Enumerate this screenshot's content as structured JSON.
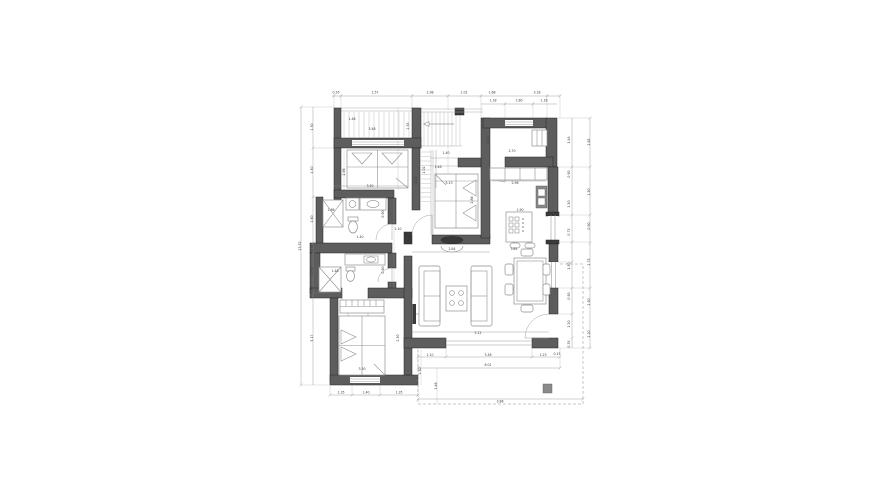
{
  "drawing": {
    "kind": "architectural floor plan",
    "visible_rooms": [
      "bedroom-top-left",
      "balcony-top-left",
      "staircase",
      "entry-hall",
      "kitchen",
      "bedroom-center",
      "bathroom-upper",
      "bathroom-lower",
      "bedroom-bottom-left",
      "living-room",
      "dining-area",
      "porch"
    ]
  },
  "colors": {
    "background": "#ffffff",
    "wall": "#5d5d5d",
    "wall_dark": "#3a3a3a",
    "outline": "#262626",
    "furniture_line": "#8f8f8f",
    "thin_line": "#ababab",
    "dimension_line": "#8c8c8c",
    "label_text": "#3c3c3c",
    "hatch": "#c9c9c9",
    "column": "#8a8a8a",
    "glass": "#9d9d9d"
  },
  "furniture_icons": [
    "double-bed-icon",
    "wardrobe-icon",
    "shower-icon",
    "toilet-icon",
    "sink-icon",
    "washing-machine-icon",
    "sofa-icon",
    "coffee-table-icon",
    "tv-icon",
    "fireplace-icon",
    "dining-table-icon",
    "chair-icon",
    "kitchen-island-icon",
    "stove-icon",
    "kitchen-sink-icon",
    "stool-icon",
    "closet-icon",
    "stair-arrow-icon",
    "column-icon"
  ],
  "dim_labels": [
    {
      "t": "0.35",
      "x": 336,
      "y": 93.5
    },
    {
      "t": "1.57",
      "x": 375,
      "y": 93.5
    },
    {
      "t": "2.98",
      "x": 430,
      "y": 93.5
    },
    {
      "t": "1.02",
      "x": 464,
      "y": 93.5
    },
    {
      "t": "1.68",
      "x": 492,
      "y": 93.5
    },
    {
      "t": "3.18",
      "x": 537,
      "y": 93.5
    },
    {
      "t": "1.18",
      "x": 493,
      "y": 101.5
    },
    {
      "t": "1.80",
      "x": 519,
      "y": 101.5
    },
    {
      "t": "1.18",
      "x": 544,
      "y": 101.5
    },
    {
      "t": "1.48",
      "x": 352,
      "y": 120
    },
    {
      "t": "3.48",
      "x": 372,
      "y": 130
    },
    {
      "t": "2.55",
      "x": 409,
      "y": 126,
      "r": -90
    },
    {
      "t": "1.02",
      "x": 425,
      "y": 170,
      "r": -90
    },
    {
      "t": "1.40",
      "x": 446,
      "y": 154
    },
    {
      "t": "2.70",
      "x": 512,
      "y": 152
    },
    {
      "t": "1.10",
      "x": 489,
      "y": 140,
      "r": -90
    },
    {
      "t": "2.96",
      "x": 515,
      "y": 184
    },
    {
      "t": "1.90",
      "x": 520,
      "y": 211
    },
    {
      "t": "3.81",
      "x": 514,
      "y": 250
    },
    {
      "t": "5.13",
      "x": 449,
      "y": 184
    },
    {
      "t": "1.46",
      "x": 438,
      "y": 168
    },
    {
      "t": "2.86",
      "x": 473,
      "y": 200,
      "r": -90
    },
    {
      "t": "3.50",
      "x": 370,
      "y": 187
    },
    {
      "t": "2.96",
      "x": 345,
      "y": 172,
      "r": -90
    },
    {
      "t": "1.86",
      "x": 331,
      "y": 211
    },
    {
      "t": "0.90",
      "x": 384,
      "y": 214,
      "r": -90
    },
    {
      "t": "1.40",
      "x": 360,
      "y": 238
    },
    {
      "t": "1.48",
      "x": 335,
      "y": 272
    },
    {
      "t": "0.80",
      "x": 384,
      "y": 270,
      "r": -90
    },
    {
      "t": "3.30",
      "x": 362,
      "y": 370
    },
    {
      "t": "2.50",
      "x": 399,
      "y": 338,
      "r": -90
    },
    {
      "t": "2.64",
      "x": 452,
      "y": 250
    },
    {
      "t": "5.12",
      "x": 478,
      "y": 334
    },
    {
      "t": "1.10",
      "x": 398,
      "y": 230
    },
    {
      "t": "2.05",
      "x": 417,
      "y": 180,
      "r": -90
    },
    {
      "t": "1.10",
      "x": 430,
      "y": 356
    },
    {
      "t": "3.46",
      "x": 488,
      "y": 356
    },
    {
      "t": "1.23",
      "x": 543,
      "y": 356
    },
    {
      "t": "0.15",
      "x": 557,
      "y": 355
    },
    {
      "t": "6.01",
      "x": 488,
      "y": 366
    },
    {
      "t": "1.48",
      "x": 570,
      "y": 140,
      "r": -90
    },
    {
      "t": "0.90",
      "x": 570,
      "y": 174,
      "r": -90
    },
    {
      "t": "1.50",
      "x": 570,
      "y": 204,
      "r": -90
    },
    {
      "t": "0.75",
      "x": 570,
      "y": 232,
      "r": -90
    },
    {
      "t": "1.50",
      "x": 570,
      "y": 266,
      "r": -90
    },
    {
      "t": "0.90",
      "x": 570,
      "y": 296,
      "r": -90
    },
    {
      "t": "1.20",
      "x": 570,
      "y": 324,
      "r": -90
    },
    {
      "t": "0.35",
      "x": 570,
      "y": 344,
      "r": -90
    },
    {
      "t": "1.65",
      "x": 590,
      "y": 142,
      "r": -90
    },
    {
      "t": "1.50",
      "x": 590,
      "y": 192,
      "r": -90
    },
    {
      "t": "0.90",
      "x": 590,
      "y": 226,
      "r": -90
    },
    {
      "t": "1.75",
      "x": 590,
      "y": 262,
      "r": -90
    },
    {
      "t": "1.50",
      "x": 590,
      "y": 302,
      "r": -90
    },
    {
      "t": "1.20",
      "x": 590,
      "y": 334,
      "r": -90
    },
    {
      "t": "1.30",
      "x": 313,
      "y": 127,
      "r": -90
    },
    {
      "t": "1.50",
      "x": 313,
      "y": 170,
      "r": -90
    },
    {
      "t": "1.60",
      "x": 313,
      "y": 219,
      "r": -90
    },
    {
      "t": "0.75",
      "x": 313,
      "y": 248,
      "r": -90
    },
    {
      "t": "1.70",
      "x": 313,
      "y": 271,
      "r": -90
    },
    {
      "t": "0.80",
      "x": 313,
      "y": 290,
      "r": -90
    },
    {
      "t": "5.17",
      "x": 313,
      "y": 338,
      "r": -90
    },
    {
      "t": "13.52",
      "x": 301,
      "y": 246,
      "r": -90
    },
    {
      "t": "1.35",
      "x": 341,
      "y": 393.5
    },
    {
      "t": "1.40",
      "x": 366,
      "y": 393.5
    },
    {
      "t": "1.35",
      "x": 399,
      "y": 393.5
    },
    {
      "t": "1.50",
      "x": 421,
      "y": 371,
      "r": -90
    },
    {
      "t": "1.46",
      "x": 437,
      "y": 386,
      "r": -90
    },
    {
      "t": "3.86",
      "x": 500,
      "y": 402.5
    }
  ]
}
